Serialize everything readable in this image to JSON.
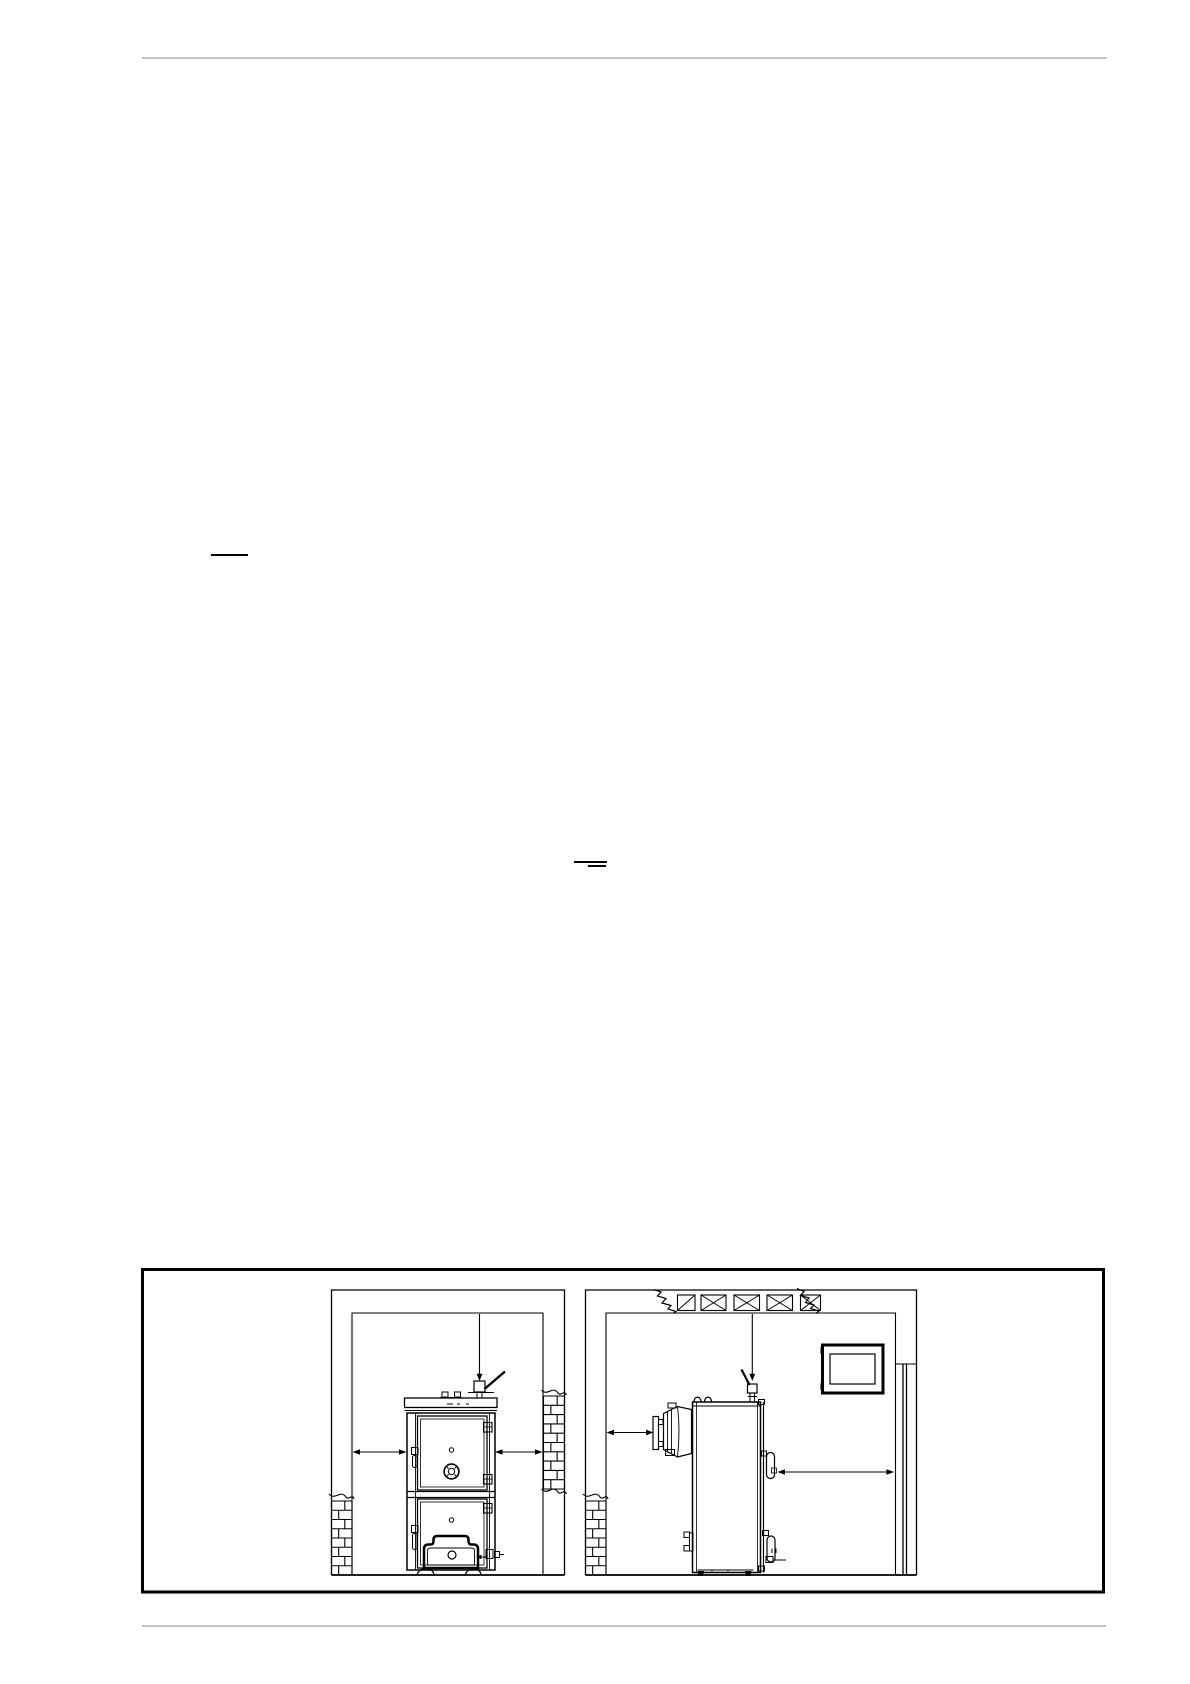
{
  "page": {
    "background": "#ffffff",
    "line_color": "#000000",
    "rule_color": "#c3c3c3"
  },
  "header": {
    "has_rule": true
  },
  "footer": {
    "has_rule": true
  },
  "body_marks": [
    {
      "type": "underline-mark",
      "x": 211,
      "y": 555,
      "width": 37
    },
    {
      "type": "underline-mark",
      "x": 574,
      "y": 861,
      "width": 33
    },
    {
      "type": "underline-mark",
      "x": 588,
      "y": 865,
      "width": 18
    }
  ],
  "figure": {
    "kind": "technical-line-drawing",
    "border_color": "#000000",
    "panels": [
      {
        "name": "boiler-installation-front-view",
        "elements": [
          "room-outline",
          "brick-wall-break-left",
          "brick-wall-break-right",
          "ceiling-clearance-arrow",
          "left-clearance-arrow",
          "right-clearance-arrow",
          "boiler-front",
          "safety-valve-with-lever",
          "pipe-stubs",
          "upper-door",
          "draft-regulator",
          "door-hinges",
          "door-latches",
          "lower-door",
          "ash-door",
          "drain-fitting",
          "boiler-feet"
        ]
      },
      {
        "name": "boiler-installation-side-view",
        "elements": [
          "room-outline",
          "ceiling-ventilation-grilles",
          "wall-break-squiggles",
          "window",
          "corner-flue-pipe",
          "brick-wall-break-left",
          "ceiling-clearance-arrow",
          "front-clearance-arrow",
          "rear-clearance-arrow",
          "boiler-side",
          "flue-damper-with-lever",
          "lifting-lugs",
          "burner-unit",
          "door-handle",
          "side-latches",
          "boiler-feet"
        ]
      }
    ]
  }
}
